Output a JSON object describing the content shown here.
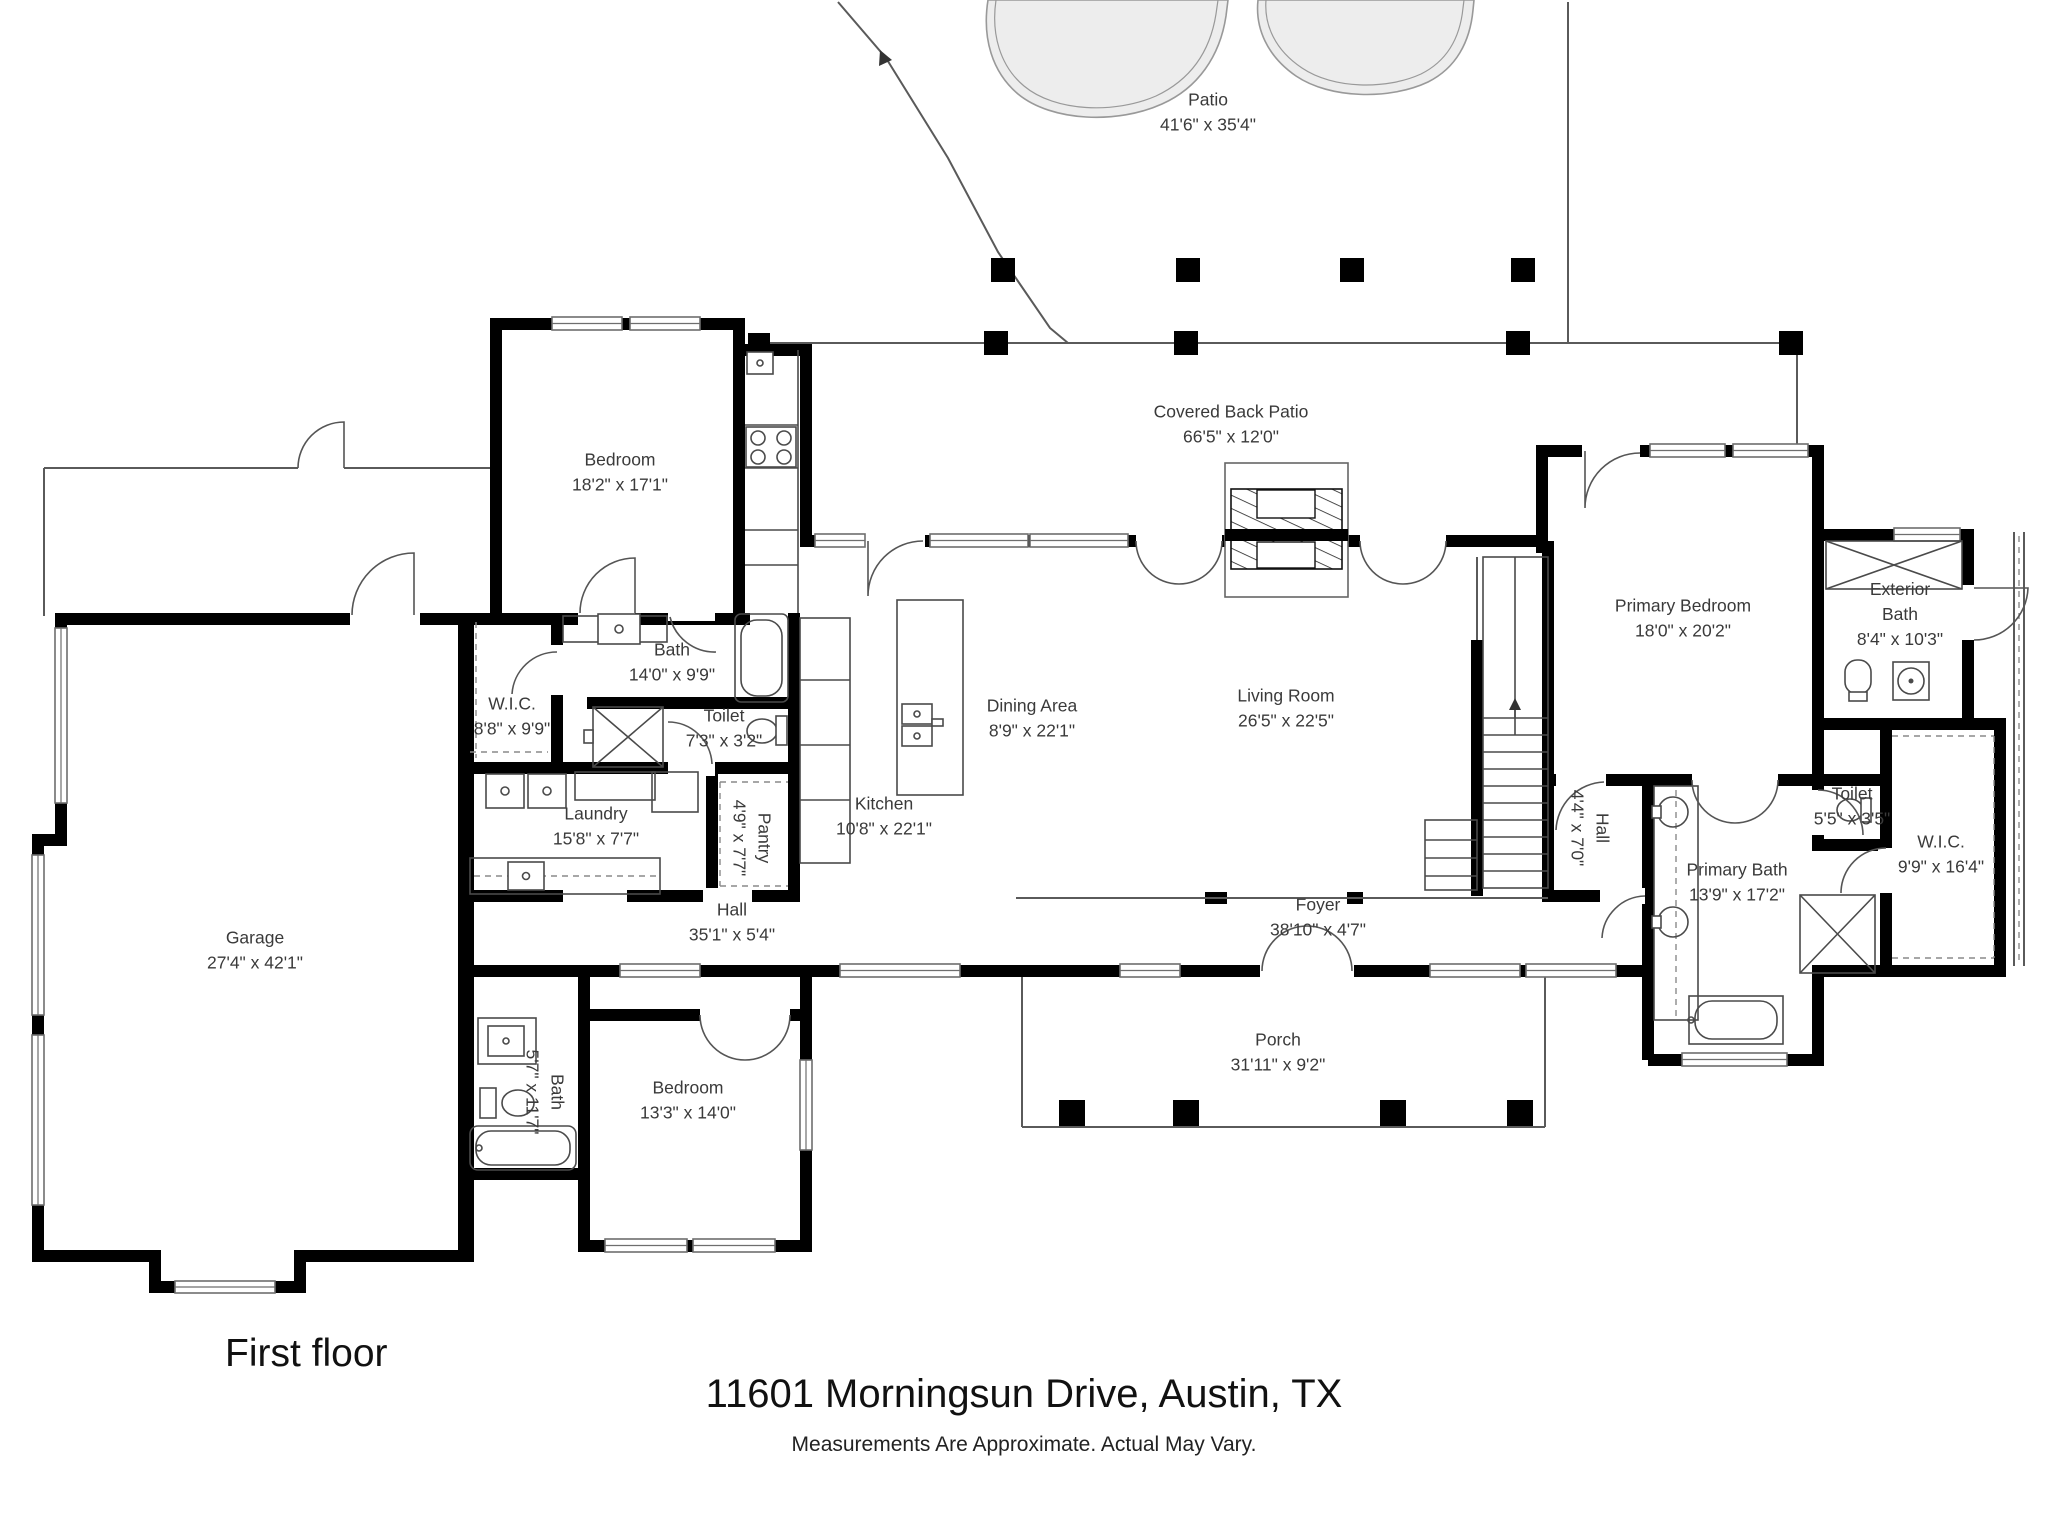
{
  "title": "11601 Morningsun Drive, Austin, TX",
  "subtitle": "Measurements Are Approximate. Actual May Vary.",
  "floor_label": "First floor",
  "colors": {
    "wall": "#000000",
    "label_text": "#3a3a3a",
    "pool_fill": "#ededed",
    "background": "#ffffff"
  },
  "rooms": [
    {
      "id": "patio",
      "lines": [
        "Patio",
        "41'6\" x 35'4\""
      ],
      "x": 1208,
      "y": 112,
      "rotate": 0
    },
    {
      "id": "covered-back-patio",
      "lines": [
        "Covered Back Patio",
        "66'5\" x 12'0\""
      ],
      "x": 1231,
      "y": 424,
      "rotate": 0
    },
    {
      "id": "bedroom-upper",
      "lines": [
        "Bedroom",
        "18'2\" x 17'1\""
      ],
      "x": 620,
      "y": 472,
      "rotate": 0
    },
    {
      "id": "bath-upper",
      "lines": [
        "Bath",
        "14'0\" x 9'9\""
      ],
      "x": 672,
      "y": 662,
      "rotate": 0
    },
    {
      "id": "wic-left",
      "lines": [
        "W.I.C.",
        "8'8\" x 9'9\""
      ],
      "x": 512,
      "y": 716,
      "rotate": 0
    },
    {
      "id": "toilet-left",
      "lines": [
        "Toilet",
        "7'3\" x 3'2\""
      ],
      "x": 724,
      "y": 728,
      "rotate": 0
    },
    {
      "id": "kitchen",
      "lines": [
        "Kitchen",
        "10'8\" x 22'1\""
      ],
      "x": 884,
      "y": 816,
      "rotate": 0
    },
    {
      "id": "dining-area",
      "lines": [
        "Dining Area",
        "8'9\" x 22'1\""
      ],
      "x": 1032,
      "y": 718,
      "rotate": 0
    },
    {
      "id": "living-room",
      "lines": [
        "Living Room",
        "26'5\" x 22'5\""
      ],
      "x": 1286,
      "y": 708,
      "rotate": 0
    },
    {
      "id": "primary-bedroom",
      "lines": [
        "Primary Bedroom",
        "18'0\" x 20'2\""
      ],
      "x": 1683,
      "y": 618,
      "rotate": 0
    },
    {
      "id": "exterior-bath",
      "lines": [
        "Exterior",
        "Bath",
        "8'4\" x 10'3\""
      ],
      "x": 1900,
      "y": 614,
      "rotate": 0
    },
    {
      "id": "hall-primary",
      "lines": [
        "Hall",
        "4'4\" x 7'0\""
      ],
      "x": 1590,
      "y": 828,
      "rotate": 90
    },
    {
      "id": "primary-bath",
      "lines": [
        "Primary Bath",
        "13'9\" x 17'2\""
      ],
      "x": 1737,
      "y": 882,
      "rotate": 0
    },
    {
      "id": "toilet-primary",
      "lines": [
        "Toilet",
        "5'5\" x 3'5\""
      ],
      "x": 1852,
      "y": 806,
      "rotate": 0
    },
    {
      "id": "wic-primary",
      "lines": [
        "W.I.C.",
        "9'9\" x 16'4\""
      ],
      "x": 1941,
      "y": 854,
      "rotate": 0
    },
    {
      "id": "garage",
      "lines": [
        "Garage",
        "27'4\" x 42'1\""
      ],
      "x": 255,
      "y": 950,
      "rotate": 0
    },
    {
      "id": "laundry",
      "lines": [
        "Laundry",
        "15'8\" x 7'7\""
      ],
      "x": 596,
      "y": 826,
      "rotate": 0
    },
    {
      "id": "pantry",
      "lines": [
        "Pantry",
        "4'9\" x 7'7\""
      ],
      "x": 752,
      "y": 838,
      "rotate": 90
    },
    {
      "id": "hall-main",
      "lines": [
        "Hall",
        "35'1\" x 5'4\""
      ],
      "x": 732,
      "y": 922,
      "rotate": 0
    },
    {
      "id": "bath-lower",
      "lines": [
        "Bath",
        "5'7\" x 11'7\""
      ],
      "x": 545,
      "y": 1092,
      "rotate": 90
    },
    {
      "id": "bedroom-lower",
      "lines": [
        "Bedroom",
        "13'3\" x 14'0\""
      ],
      "x": 688,
      "y": 1100,
      "rotate": 0
    },
    {
      "id": "foyer",
      "lines": [
        "Foyer",
        "38'10\" x 4'7\""
      ],
      "x": 1318,
      "y": 917,
      "rotate": 0
    },
    {
      "id": "porch",
      "lines": [
        "Porch",
        "31'11\" x 9'2\""
      ],
      "x": 1278,
      "y": 1052,
      "rotate": 0
    }
  ]
}
